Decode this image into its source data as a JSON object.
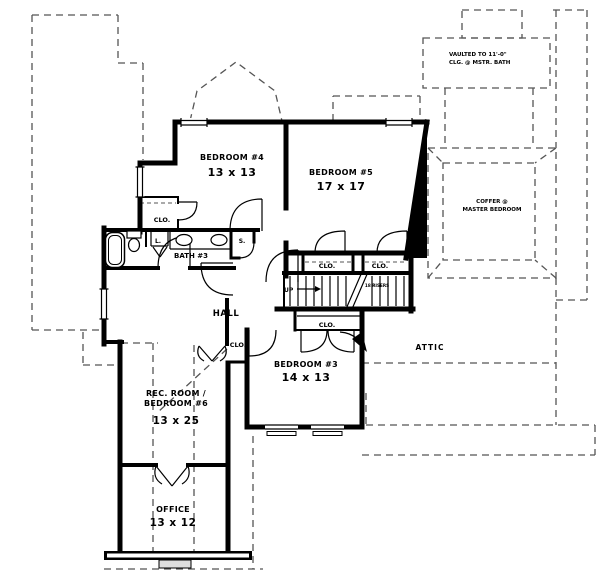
{
  "plan": {
    "rooms": {
      "bedroom4": {
        "name": "BEDROOM #4",
        "dims": "13 x 13"
      },
      "bedroom5": {
        "name": "BEDROOM #5",
        "dims": "17 x 17"
      },
      "bedroom3": {
        "name": "BEDROOM #3",
        "dims": "14 x 13"
      },
      "rec_room": {
        "name1": "REC. ROOM /",
        "name2": "BEDROOM #6",
        "dims": "13 x 25"
      },
      "office": {
        "name": "OFFICE",
        "dims": "13 x 12"
      },
      "bath3": {
        "name": "BATH #3"
      },
      "hall": {
        "name": "HALL"
      },
      "attic": {
        "name": "ATTIC"
      }
    },
    "notes": {
      "vaulted1": "VAULTED TO 11'-0\"",
      "vaulted2": "CLG. @ MSTR. BATH",
      "coffer1": "COFFER @",
      "coffer2": "MASTER BEDROOM",
      "stair_up": "UP",
      "stair_risers": "18 RISERS"
    },
    "labels": {
      "closet": "CLO.",
      "linen": "L.",
      "shower": "S."
    },
    "colors": {
      "wall": "#000000",
      "dashed": "#555555",
      "background": "#ffffff"
    }
  }
}
